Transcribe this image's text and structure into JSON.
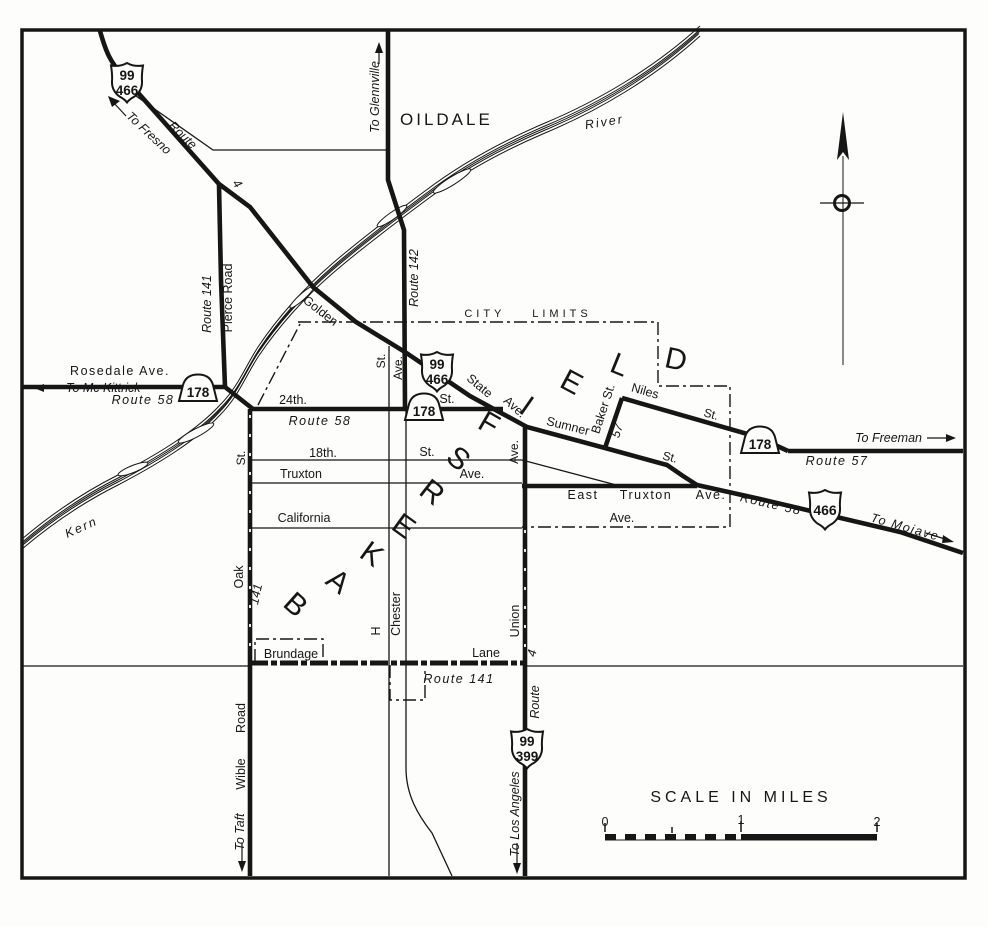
{
  "city": {
    "name": "BAKERSFIELD",
    "letters": [
      "B",
      "A",
      "K",
      "E",
      "R",
      "S",
      "F",
      "I",
      "E",
      "L",
      "D"
    ]
  },
  "places": {
    "oildale": "OILDALE"
  },
  "river": {
    "kern": "Kern",
    "river": "River"
  },
  "boundary": {
    "city_limits": "CITY LIMITS"
  },
  "abbr": {
    "st": "St.",
    "ave": "Ave."
  },
  "streets": {
    "rosedale": "Rosedale Ave.",
    "pierce": "Pierce Road",
    "golden": "Golden",
    "state": "State",
    "sumner": "Sumner",
    "baker": "Baker St.",
    "niles": "Niles",
    "east": "East",
    "truxton_east": "Truxton",
    "st_24th": "24th.",
    "st_18th": "18th.",
    "truxton": "Truxton",
    "california": "California",
    "oak": "Oak",
    "h": "H",
    "chester": "Chester",
    "union": "Union",
    "brundage": "Brundage",
    "lane": "Lane",
    "wible": "Wible",
    "road": "Road"
  },
  "routes": {
    "route_58": "Route 58",
    "route_57": "Route 57",
    "route_141": "Route 141",
    "route_142": "Route 142",
    "route_word": "Route",
    "legislative_4": "4",
    "legislative_57": "57",
    "legislative_141": "141"
  },
  "destinations": {
    "fresno": "To Fresno",
    "glennville": "To Glennville",
    "mckittrick": "To Mc Kittrick",
    "freeman": "To Freeman",
    "mojave": "To Mojave",
    "los_angeles": "To Los Angeles",
    "taft": "To Taft"
  },
  "shields": {
    "us99_466_nw": {
      "top": "99",
      "bottom": "466"
    },
    "us99_466_central": {
      "top": "99",
      "bottom": "466"
    },
    "us466_east": {
      "number": "466"
    },
    "us99_399_south": {
      "top": "99",
      "bottom": "399"
    },
    "sr178": {
      "number": "178"
    }
  },
  "scale_bar": {
    "title": "SCALE IN MILES",
    "tick_0": "0",
    "tick_1": "1",
    "tick_2": "2"
  }
}
